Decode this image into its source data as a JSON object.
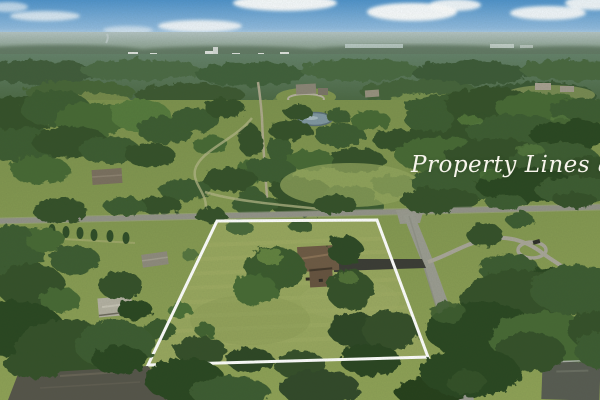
{
  "meta": {
    "image_type": "aerial-drone-photo",
    "subject": "rural residential property with marked boundary"
  },
  "watermark": {
    "text": "Property Lines are Approximate",
    "color": "#f7f5ec"
  },
  "scene": {
    "sky_color": "#5e9bce",
    "haze_color": "#a2b5b2",
    "field_color": "#8ea259",
    "forest_color": "#3a5730",
    "lawn_color": "#98a75f",
    "road_color": "#94948a",
    "side_road_color": "#9b9c92",
    "driveway_color": "#3b3c36",
    "boundary_color": "#ffffff",
    "house_roof_color": "#6e5a45",
    "pond_color": "#8097a2",
    "features": [
      "sky",
      "clouds",
      "distant-treeline",
      "distant-buildings",
      "far-forest",
      "fields",
      "pond",
      "estate-lane",
      "main-road",
      "side-road",
      "property-boundary",
      "subject-house",
      "asphalt-driveway",
      "neighbor-houses",
      "bottom-forest"
    ]
  }
}
